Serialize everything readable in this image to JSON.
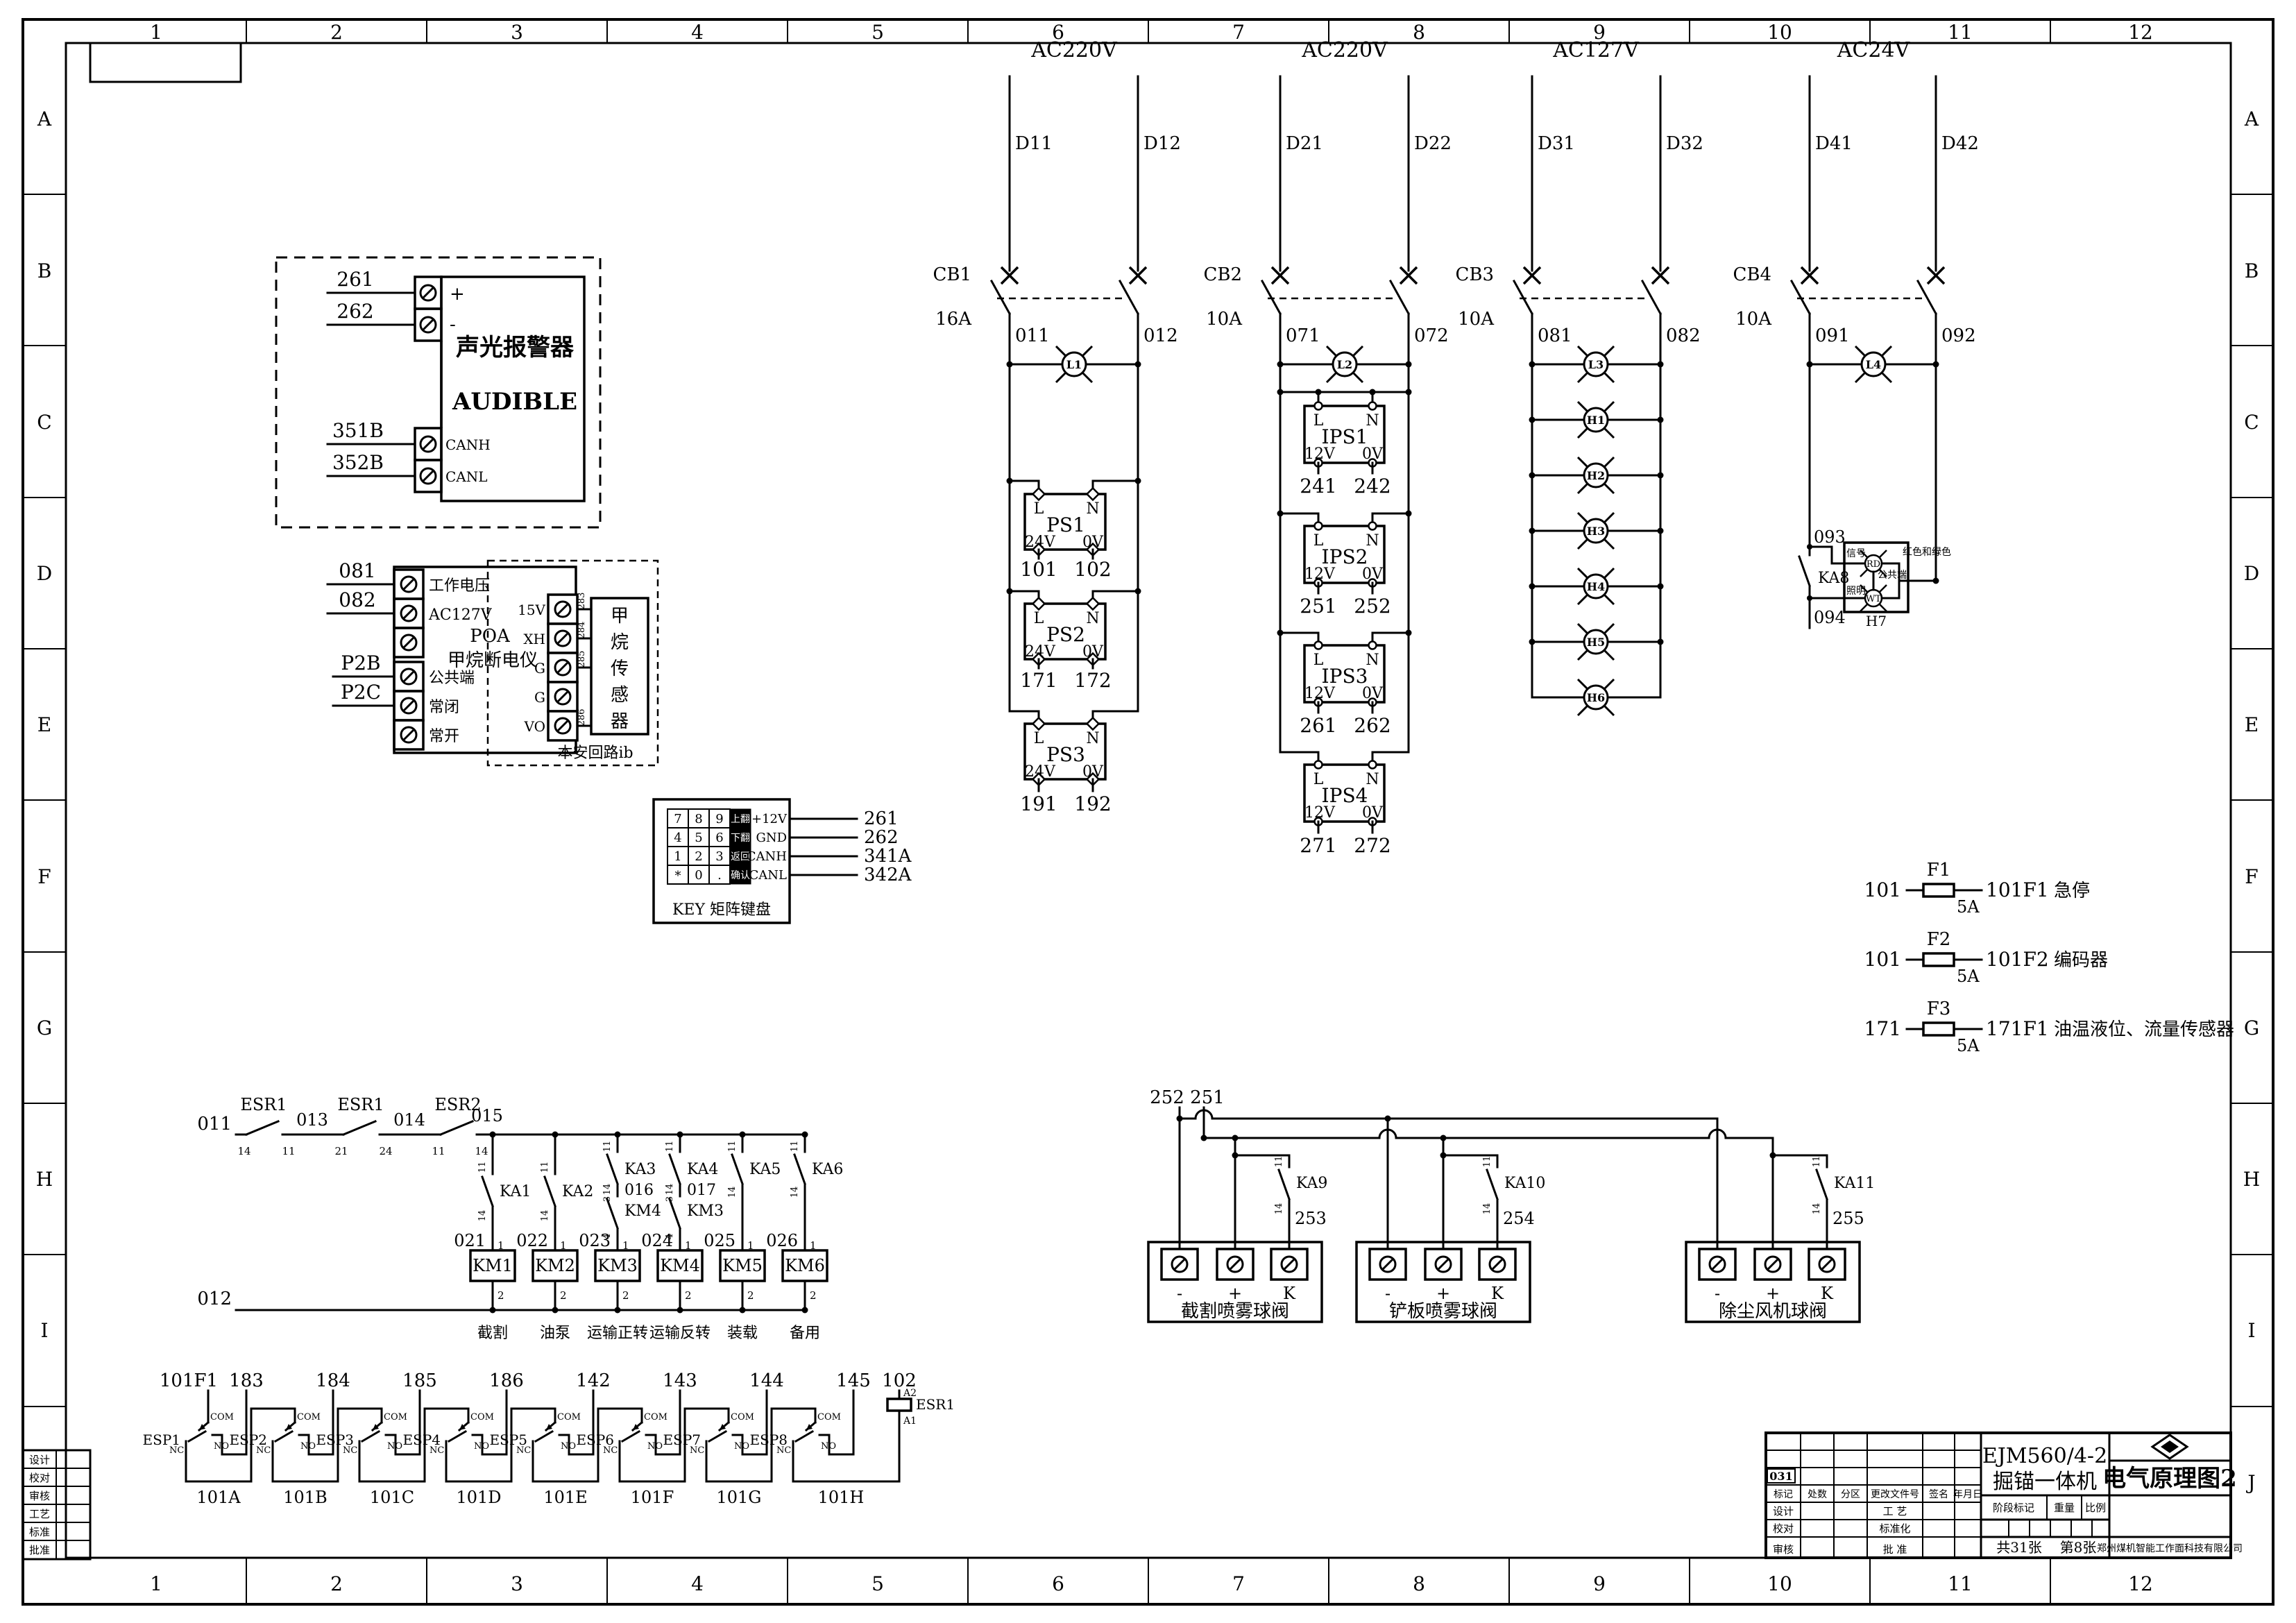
{
  "frame": {
    "cols": [
      "1",
      "2",
      "3",
      "4",
      "5",
      "6",
      "7",
      "8",
      "9",
      "10",
      "11",
      "12"
    ],
    "rows": [
      "A",
      "B",
      "C",
      "D",
      "E",
      "F",
      "G",
      "H",
      "I",
      "J"
    ]
  },
  "audible": {
    "w": [
      "261",
      "262",
      "351B",
      "352B"
    ],
    "t": [
      "+",
      "-",
      "CANH",
      "CANL"
    ],
    "cn": "声光报警器",
    "en": "AUDIBLE"
  },
  "methane": {
    "w": [
      "081",
      "082",
      "P2B",
      "P2C"
    ],
    "lt": [
      "工作电压",
      "AC127V",
      "公共端",
      "常闭",
      "常开"
    ],
    "unit": "POA",
    "unit_name": "甲烷断电仪",
    "rt": [
      "15V",
      "XH",
      "G",
      "G",
      "VO"
    ],
    "lw": [
      "283",
      "284",
      "285",
      "286"
    ],
    "sensor": "甲烷传感器",
    "loop": "本安回路ib"
  },
  "keypad": {
    "k": [
      "7",
      "8",
      "9",
      "上翻",
      "4",
      "5",
      "6",
      "下翻",
      "1",
      "2",
      "3",
      "返回",
      "*",
      "0",
      ".",
      "确认"
    ],
    "p": [
      "+12V",
      "GND",
      "CANH",
      "CANL"
    ],
    "pw": [
      "261",
      "262",
      "341A",
      "342A"
    ],
    "cap": "KEY 矩阵键盘"
  },
  "g1": {
    "v": "AC220V",
    "dl": "D11",
    "dr": "D12",
    "cb": "CB1",
    "a": "16A",
    "wl": "011",
    "wr": "012",
    "lamp": "L1",
    "L": "L",
    "N": "N",
    "o1": "24V",
    "o2": "0V",
    "ps": [
      {
        "n": "PS1",
        "wl": "101",
        "wr": "102"
      },
      {
        "n": "PS2",
        "wl": "171",
        "wr": "172"
      },
      {
        "n": "PS3",
        "wl": "191",
        "wr": "192"
      }
    ]
  },
  "g2": {
    "v": "AC220V",
    "dl": "D21",
    "dr": "D22",
    "cb": "CB2",
    "a": "10A",
    "wl": "071",
    "wr": "072",
    "lamp": "L2",
    "L": "L",
    "N": "N",
    "o1": "12V",
    "o2": "0V",
    "ips": [
      {
        "n": "IPS1",
        "wl": "241",
        "wr": "242"
      },
      {
        "n": "IPS2",
        "wl": "251",
        "wr": "252"
      },
      {
        "n": "IPS3",
        "wl": "261",
        "wr": "262"
      },
      {
        "n": "IPS4",
        "wl": "271",
        "wr": "272"
      }
    ]
  },
  "g3": {
    "v": "AC127V",
    "dl": "D31",
    "dr": "D32",
    "cb": "CB3",
    "a": "10A",
    "wl": "081",
    "wr": "082",
    "lamps": [
      "L3",
      "H1",
      "H2",
      "H3",
      "H4",
      "H5",
      "H6"
    ]
  },
  "g4": {
    "v": "AC24V",
    "dl": "D41",
    "dr": "D42",
    "cb": "CB4",
    "a": "10A",
    "wl": "091",
    "wr": "092",
    "lamp": "L4",
    "wt": "093",
    "ka": "KA8",
    "wb": "094",
    "box": "H7",
    "rd": "RD",
    "wl2": "WT",
    "sig": "信号",
    "color": "红色和绿色",
    "com": "公共端",
    "light": "照明"
  },
  "fuses": [
    {
      "f": "101",
      "n": "F1",
      "a": "5A",
      "t": "101F1",
      "d": "急停"
    },
    {
      "f": "101",
      "n": "F2",
      "a": "5A",
      "t": "101F2",
      "d": "编码器"
    },
    {
      "f": "171",
      "n": "F3",
      "a": "5A",
      "t": "171F1",
      "d": "油温液位、流量传感器"
    }
  ],
  "ladder": {
    "wt": "011",
    "wb": "012",
    "series": [
      {
        "n": "ESR1",
        "a": "14",
        "b": "11",
        "w": "013"
      },
      {
        "n": "ESR1",
        "a": "21",
        "b": "24",
        "w": "014"
      },
      {
        "n": "ESR2",
        "a": "11",
        "b": "14",
        "w": "015"
      }
    ],
    "br": [
      {
        "ka": "KA1",
        "a": "11",
        "b": "14",
        "w": "021",
        "p1": "1",
        "km": "KM1",
        "p2": "2",
        "f": "截割"
      },
      {
        "ka": "KA2",
        "a": "11",
        "b": "14",
        "w": "022",
        "p1": "1",
        "km": "KM2",
        "p2": "2",
        "f": "油泵"
      },
      {
        "ka": "KA3",
        "a": "11",
        "b": "14",
        "m": "016",
        "nc": "KM4",
        "c": "3",
        "d": "4",
        "w": "023",
        "p1": "1",
        "km": "KM3",
        "p2": "2",
        "f": "运输正转"
      },
      {
        "ka": "KA4",
        "a": "11",
        "b": "14",
        "m": "017",
        "nc": "KM3",
        "c": "3",
        "d": "4",
        "w": "024",
        "p1": "1",
        "km": "KM4",
        "p2": "2",
        "f": "运输反转"
      },
      {
        "ka": "KA5",
        "a": "11",
        "b": "14",
        "w": "025",
        "p1": "1",
        "km": "KM5",
        "p2": "2",
        "f": "装载"
      },
      {
        "ka": "KA6",
        "a": "11",
        "b": "14",
        "w": "026",
        "p1": "1",
        "km": "KM6",
        "p2": "2",
        "f": "备用"
      }
    ]
  },
  "valves": {
    "f1": "252",
    "f2": "251",
    "items": [
      {
        "ka": "KA9",
        "a": "11",
        "b": "14",
        "w": "253",
        "m": "-",
        "p": "+",
        "k": "K",
        "name": "截割喷雾球阀"
      },
      {
        "ka": "KA10",
        "a": "11",
        "b": "14",
        "w": "254",
        "m": "-",
        "p": "+",
        "k": "K",
        "name": "铲板喷雾球阀"
      },
      {
        "ka": "KA11",
        "a": "11",
        "b": "14",
        "w": "255",
        "m": "-",
        "p": "+",
        "k": "K",
        "name": "除尘风机球阀"
      }
    ]
  },
  "esp": {
    "feed": "101F1",
    "coilw": "102",
    "coil": "ESR1",
    "a2": "A2",
    "a1": "A1",
    "com": "COM",
    "nc": "NC",
    "no": "NO",
    "sw": [
      {
        "n": "ESP1",
        "t": "183",
        "l": "101A"
      },
      {
        "n": "ESP2",
        "t": "184",
        "l": "101B"
      },
      {
        "n": "ESP3",
        "t": "185",
        "l": "101C"
      },
      {
        "n": "ESP4",
        "t": "186",
        "l": "101D"
      },
      {
        "n": "ESP5",
        "t": "142",
        "l": "101E"
      },
      {
        "n": "ESP6",
        "t": "143",
        "l": "101F"
      },
      {
        "n": "ESP7",
        "t": "144",
        "l": "101G"
      },
      {
        "n": "ESP8",
        "t": "145",
        "l": "101H"
      }
    ]
  },
  "tb": {
    "rev": "031",
    "hdr": [
      "标记",
      "处数",
      "分区",
      "更改文件号",
      "签名",
      "年月日"
    ],
    "r1l": "设计",
    "r1r": "工 艺",
    "r2l": "校对",
    "r2r": "标准化",
    "r3l": "审核",
    "r3r": "批 准",
    "model": "EJM560/4-2",
    "machine": "掘锚一体机",
    "title": "电气原理图2",
    "stage": "阶段标记",
    "weight": "重量",
    "scale": "比例",
    "sheets": "共31张",
    "sheet": "第8张",
    "company": "郑州煤机智能工作面科技有限公司"
  },
  "sign": [
    "设计",
    "校对",
    "审核",
    "工艺",
    "标准",
    "批准"
  ]
}
